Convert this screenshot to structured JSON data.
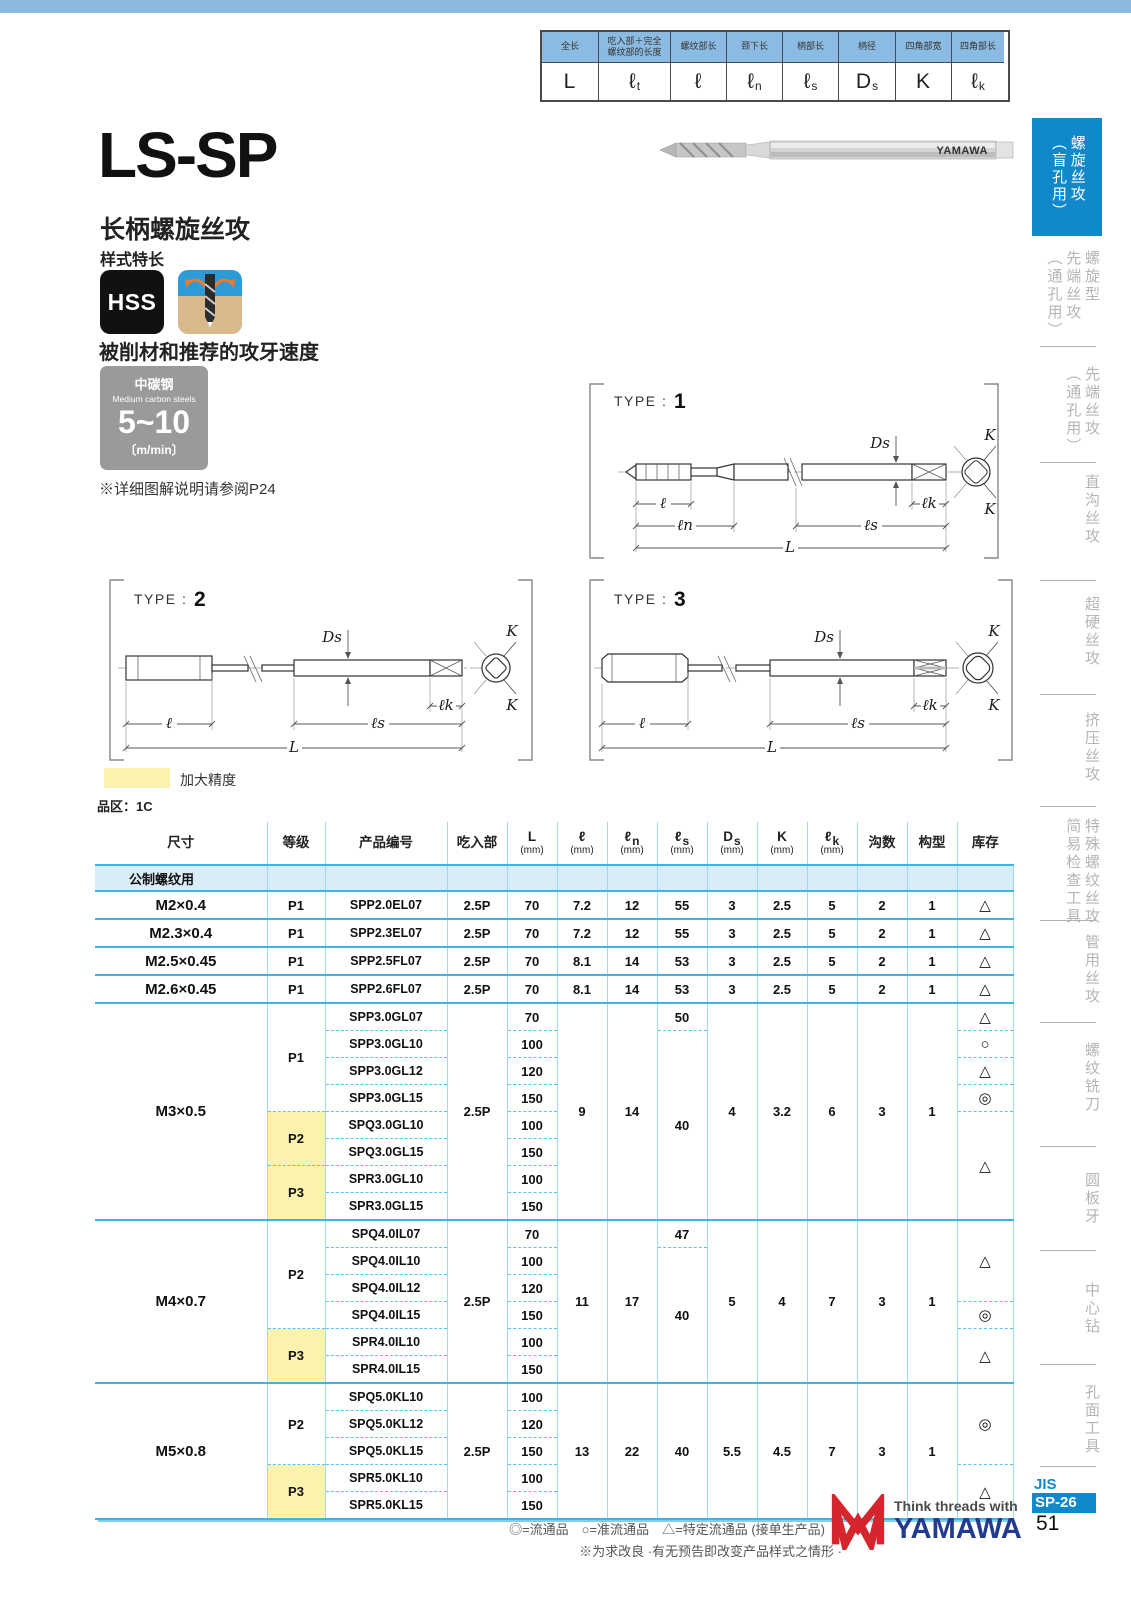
{
  "dim_legend": {
    "labels": [
      "全长",
      "吃入部＋完全\n螺纹部的长度",
      "螺纹部长",
      "颈下长",
      "柄部长",
      "柄径",
      "四角部宽",
      "四角部长"
    ],
    "symbols": [
      {
        "main": "L"
      },
      {
        "main": "ℓ",
        "sub": "t"
      },
      {
        "main": "ℓ"
      },
      {
        "main": "ℓ",
        "sub": "n"
      },
      {
        "main": "ℓ",
        "sub": "s"
      },
      {
        "main": "D",
        "sub": "s"
      },
      {
        "main": "K"
      },
      {
        "main": "ℓ",
        "sub": "k"
      }
    ]
  },
  "header": {
    "title": "LS-SP",
    "subtitle": "长柄螺旋丝攻",
    "style_note": "样式特长",
    "hss": "HSS"
  },
  "photo": {
    "brand": "YAMAWA"
  },
  "speed": {
    "heading": "被削材和推荐的攻牙速度",
    "material_cn": "中碳钢",
    "material_en": "Medium carbon steels",
    "range": "5~10",
    "unit": "〔m/min〕",
    "note": "※详细图解说明请参阅P24"
  },
  "types": [
    {
      "prefix": "TYPE :",
      "num": "1"
    },
    {
      "prefix": "TYPE :",
      "num": "2"
    },
    {
      "prefix": "TYPE :",
      "num": "3"
    }
  ],
  "dims": {
    "l": "ℓ",
    "ln": "ℓn",
    "ls": "ℓs",
    "L": "L",
    "Ds": "Ds",
    "lk": "ℓk",
    "K": "K"
  },
  "legend": {
    "swatch_label": "加大精度",
    "series_label": "品区：1C"
  },
  "table": {
    "headers": [
      {
        "main": "尺寸"
      },
      {
        "main": "等级"
      },
      {
        "main": "产品编号"
      },
      {
        "main": "吃入部"
      },
      {
        "main": "L",
        "unit": "(mm)"
      },
      {
        "main": "ℓ",
        "unit": "(mm)"
      },
      {
        "main": "ℓ",
        "sub": "n",
        "unit": "(mm)"
      },
      {
        "main": "ℓ",
        "sub": "s",
        "unit": "(mm)"
      },
      {
        "main": "D",
        "sub": "s",
        "unit": "(mm)"
      },
      {
        "main": "K",
        "unit": "(mm)"
      },
      {
        "main": "ℓ",
        "sub": "k",
        "unit": "(mm)"
      },
      {
        "main": "沟数"
      },
      {
        "main": "构型"
      },
      {
        "main": "库存"
      }
    ],
    "section": "公制螺纹用",
    "groups": [
      {
        "size": "M2×0.4",
        "grades": [
          {
            "label": "P1"
          }
        ],
        "rows": [
          {
            "code": "SPP2.0EL07",
            "L": "70"
          }
        ],
        "chamfer": "2.5P",
        "l": "7.2",
        "ln": "12",
        "ls": "55",
        "Ds": "3",
        "K": "2.5",
        "lk": "5",
        "flutes": "2",
        "form": "1",
        "stocks": [
          "△"
        ]
      },
      {
        "size": "M2.3×0.4",
        "grades": [
          {
            "label": "P1"
          }
        ],
        "rows": [
          {
            "code": "SPP2.3EL07",
            "L": "70"
          }
        ],
        "chamfer": "2.5P",
        "l": "7.2",
        "ln": "12",
        "ls": "55",
        "Ds": "3",
        "K": "2.5",
        "lk": "5",
        "flutes": "2",
        "form": "1",
        "stocks": [
          "△"
        ]
      },
      {
        "size": "M2.5×0.45",
        "grades": [
          {
            "label": "P1"
          }
        ],
        "rows": [
          {
            "code": "SPP2.5FL07",
            "L": "70"
          }
        ],
        "chamfer": "2.5P",
        "l": "8.1",
        "ln": "14",
        "ls": "53",
        "Ds": "3",
        "K": "2.5",
        "lk": "5",
        "flutes": "2",
        "form": "1",
        "stocks": [
          "△"
        ]
      },
      {
        "size": "M2.6×0.45",
        "grades": [
          {
            "label": "P1"
          }
        ],
        "rows": [
          {
            "code": "SPP2.6FL07",
            "L": "70"
          }
        ],
        "chamfer": "2.5P",
        "l": "8.1",
        "ln": "14",
        "ls": "53",
        "Ds": "3",
        "K": "2.5",
        "lk": "5",
        "flutes": "2",
        "form": "1",
        "stocks": [
          "△"
        ]
      },
      {
        "size": "M3×0.5",
        "grades": [
          {
            "label": "P1"
          },
          {
            "label": "P2"
          },
          {
            "label": "P3"
          }
        ],
        "rows": [
          {
            "code": "SPP3.0GL07",
            "L": "70"
          },
          {
            "code": "SPP3.0GL10",
            "L": "100"
          },
          {
            "code": "SPP3.0GL12",
            "L": "120"
          },
          {
            "code": "SPP3.0GL15",
            "L": "150"
          },
          {
            "code": "SPQ3.0GL10",
            "L": "100"
          },
          {
            "code": "SPQ3.0GL15",
            "L": "150"
          },
          {
            "code": "SPR3.0GL10",
            "L": "100"
          },
          {
            "code": "SPR3.0GL15",
            "L": "150"
          }
        ],
        "chamfer": "2.5P",
        "l": "9",
        "ln": "14",
        "ls_first": "50",
        "ls": "40",
        "Ds": "4",
        "K": "3.2",
        "lk": "6",
        "flutes": "3",
        "form": "1",
        "stocks": [
          "△",
          "○",
          "△",
          "◎",
          "△"
        ]
      },
      {
        "size": "M4×0.7",
        "grades": [
          {
            "label": "P2"
          },
          {
            "label": "P3"
          }
        ],
        "rows": [
          {
            "code": "SPQ4.0IL07",
            "L": "70"
          },
          {
            "code": "SPQ4.0IL10",
            "L": "100"
          },
          {
            "code": "SPQ4.0IL12",
            "L": "120"
          },
          {
            "code": "SPQ4.0IL15",
            "L": "150"
          },
          {
            "code": "SPR4.0IL10",
            "L": "100"
          },
          {
            "code": "SPR4.0IL15",
            "L": "150"
          }
        ],
        "chamfer": "2.5P",
        "l": "11",
        "ln": "17",
        "ls_first": "47",
        "ls": "40",
        "Ds": "5",
        "K": "4",
        "lk": "7",
        "flutes": "3",
        "form": "1",
        "stocks": [
          "△",
          "◎",
          "△"
        ]
      },
      {
        "size": "M5×0.8",
        "grades": [
          {
            "label": "P2"
          },
          {
            "label": "P3"
          }
        ],
        "rows": [
          {
            "code": "SPQ5.0KL10",
            "L": "100"
          },
          {
            "code": "SPQ5.0KL12",
            "L": "120"
          },
          {
            "code": "SPQ5.0KL15",
            "L": "150"
          },
          {
            "code": "SPR5.0KL10",
            "L": "100"
          },
          {
            "code": "SPR5.0KL15",
            "L": "150"
          }
        ],
        "chamfer": "2.5P",
        "l": "13",
        "ln": "22",
        "ls": "40",
        "Ds": "5.5",
        "K": "4.5",
        "lk": "7",
        "flutes": "3",
        "form": "1",
        "stocks": [
          "◎",
          "△"
        ]
      }
    ]
  },
  "sidebar": {
    "items": [
      {
        "label": "螺旋丝攻\n（盲孔用）",
        "active": true
      },
      {
        "label": "螺旋型\n先端丝攻\n（通孔用）"
      },
      {
        "label": "先端丝攻\n（通孔用）"
      },
      {
        "label": "直沟丝攻"
      },
      {
        "label": "超硬丝攻"
      },
      {
        "label": "挤压丝攻"
      },
      {
        "label": "特殊螺纹丝攻\n简易检查工具"
      },
      {
        "label": "管用丝攻"
      },
      {
        "label": "螺纹铣刀"
      },
      {
        "label": "圆板牙"
      },
      {
        "label": "中心钻"
      },
      {
        "label": "孔面工具"
      }
    ]
  },
  "footer": {
    "stock_legend": "◎=流通品　○=准流通品　△=特定流通品 (接单生产品)",
    "note": "※为求改良 ·有无预告即改变产品样式之情形 ·",
    "tagline": "Think threads with",
    "brand": "YAMAWA",
    "jis": "JIS",
    "code": "SP-26",
    "page": "51"
  },
  "colors": {
    "accent_blue": "#1188C9",
    "table_line_blue": "#3FB3E4",
    "table_grid_blue": "#9FDCF2",
    "section_bg": "#D9EDF8",
    "precision_yellow": "#FBF2AE",
    "legend_header_blue": "#8BBBE2",
    "brand_blue": "#223A8F",
    "brand_red": "#D6252C",
    "top_bar": "#8CB9DE"
  }
}
